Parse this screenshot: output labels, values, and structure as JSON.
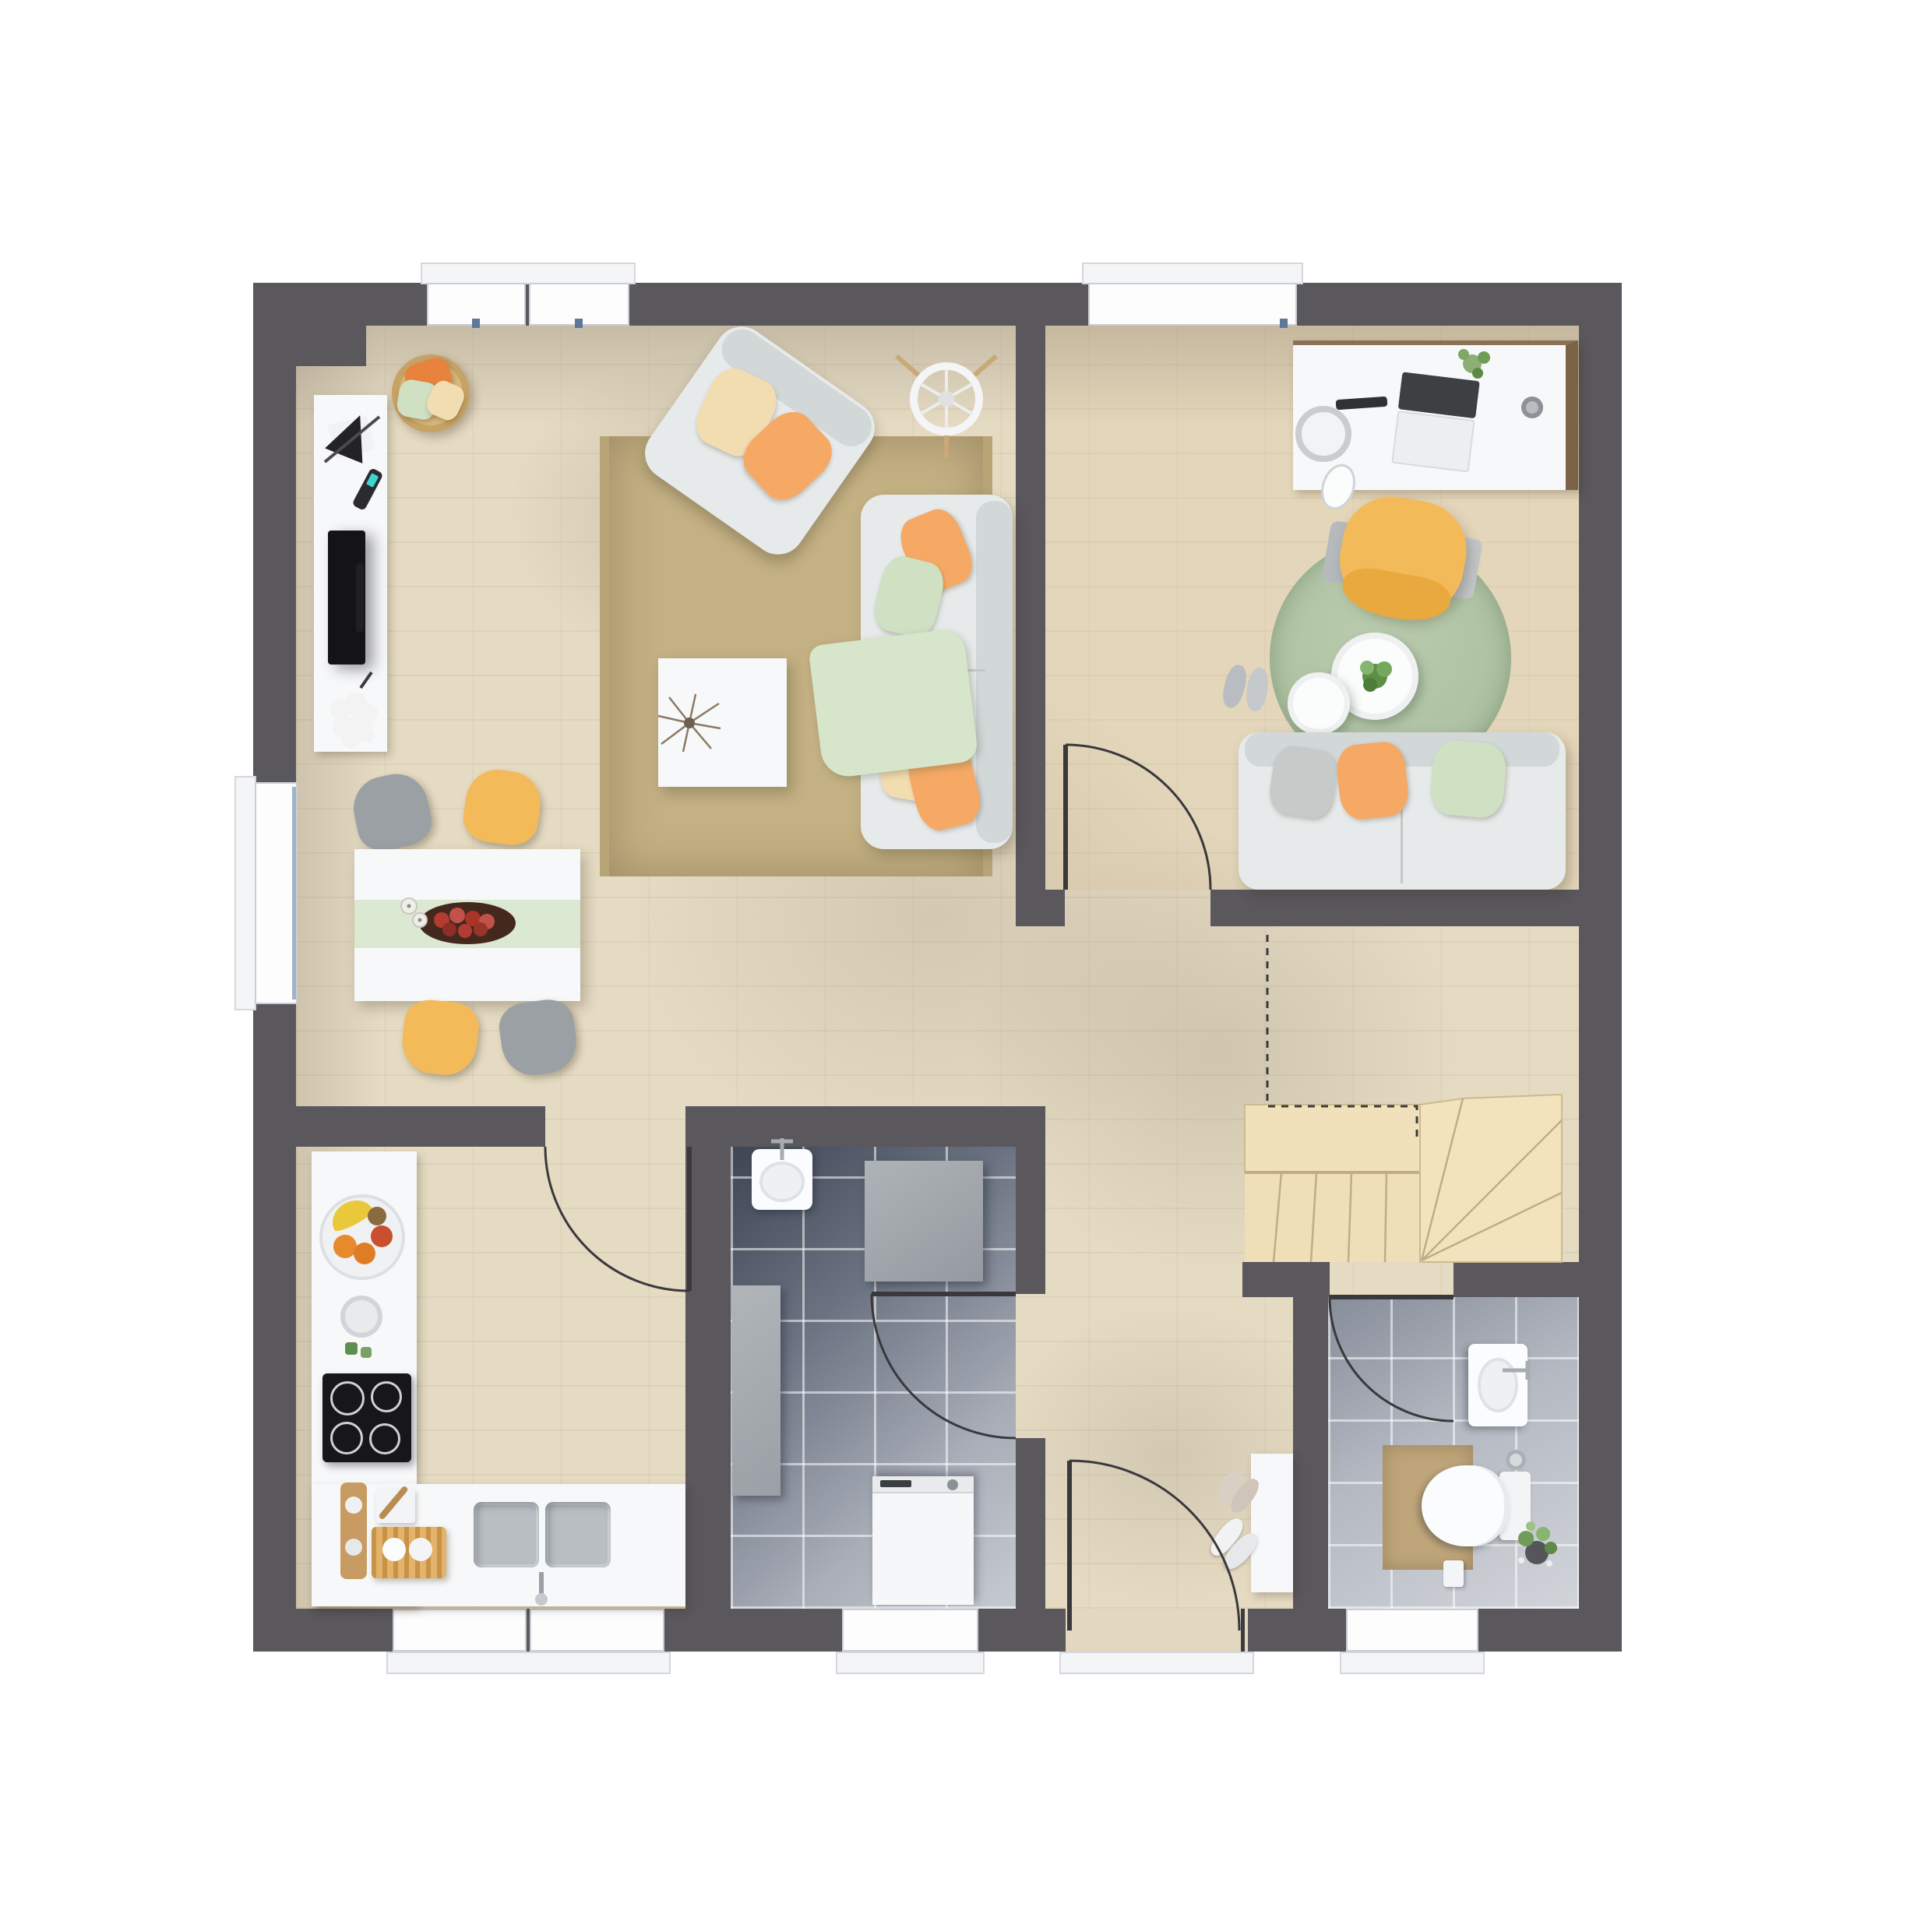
{
  "meta": {
    "type": "floor-plan",
    "view": "top-down",
    "visible_text": []
  },
  "palette": {
    "paper": "#ffffff",
    "wall": "#5a575d",
    "wood": "#e5dac2",
    "wood-dark": "#d8cbb0",
    "stairs": "#f0e1ba",
    "rug-tan": "#c3b083",
    "rug-green": "#adc2a2",
    "sofa": "#e7eaea",
    "sofa-shade": "#d2d7d8",
    "orange": "#f6a965",
    "cream": "#f2ddb0",
    "sage": "#cfe0c3",
    "pillow-gray": "#c6cac9",
    "chair-yellow": "#f3ba5a",
    "chair-gray": "#9ba0a4",
    "counter": "#f7f8f9",
    "cooktop": "#17171a",
    "steel": "#b9bec3",
    "tile-dark": "#414957",
    "tile-light": "#c5c9d0",
    "wc-tile": "#aeb3bd",
    "mat": "#bfa67a",
    "desk-wood": "#7c6347",
    "arc": "#39383d",
    "plant-green": "#6f9c58"
  },
  "rooms": [
    {
      "id": "living-room",
      "furniture": [
        "tv-sideboard",
        "tv",
        "remote-control",
        "sculpture",
        "flower-vase",
        "laundry-basket",
        "armchair",
        "sofa",
        "coffee-table",
        "dried-flower",
        "area-rug",
        "wall-clock-decor"
      ]
    },
    {
      "id": "dining-area",
      "furniture": [
        "dining-table",
        "table-runner",
        "fruit-bowl",
        "candles",
        "chair-gray",
        "chair-yellow",
        "chair-yellow",
        "chair-gray",
        "terrace-door"
      ]
    },
    {
      "id": "office",
      "furniture": [
        "desk",
        "laptop",
        "keyboard",
        "headphones",
        "mouse",
        "desk-plant",
        "office-chair",
        "round-rug",
        "side-table-large",
        "side-table-small",
        "plant",
        "sofa",
        "slippers"
      ]
    },
    {
      "id": "kitchen",
      "furniture": [
        "l-counter",
        "fruit-plate",
        "deco-bowl",
        "bottles",
        "cutting-board",
        "induction-cooktop",
        "dish-towel",
        "dish-rack",
        "double-sink",
        "faucet"
      ]
    },
    {
      "id": "bathroom",
      "furniture": [
        "wash-basin",
        "shower-box",
        "tall-cabinet",
        "washing-machine"
      ]
    },
    {
      "id": "wc",
      "furniture": [
        "wall-sink",
        "toilet",
        "bath-mat",
        "toilet-brush",
        "plant"
      ]
    },
    {
      "id": "hallway",
      "furniture": [
        "shoe-cabinet",
        "slippers",
        "sneakers",
        "entrance-door"
      ]
    },
    {
      "id": "staircase",
      "parts": [
        "landing",
        "straight-treads",
        "winder-wedges",
        "headroom-dashed-line"
      ]
    }
  ],
  "openings": {
    "windows": [
      "living-window",
      "office-window",
      "kitchen-window",
      "utility-window",
      "wc-window"
    ],
    "doors": [
      "terrace-door",
      "living-to-hall-door",
      "kitchen-door",
      "bathroom-door",
      "wc-door",
      "entrance-door"
    ]
  },
  "chart_data": null
}
